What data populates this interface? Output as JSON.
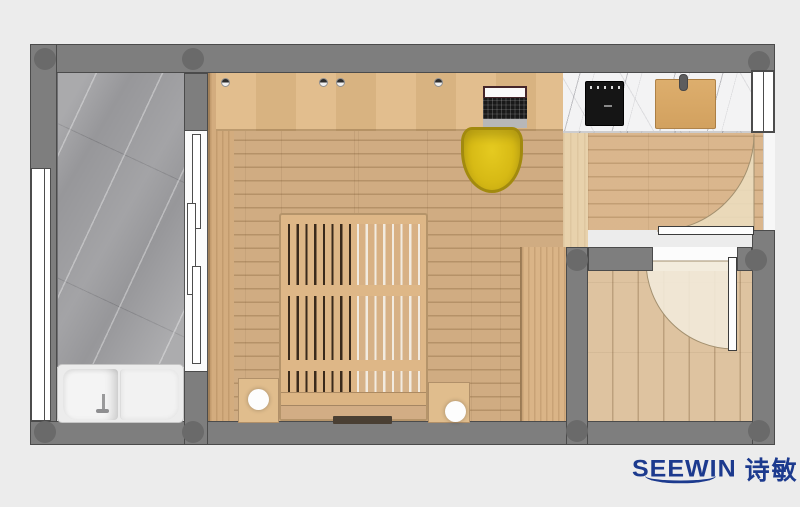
{
  "brand": {
    "name_en": "SEEWIN",
    "name_zh": "诗敏",
    "color": "#1c3a8e"
  },
  "plan": {
    "type": "apartment-floor-plan-top-view",
    "rooms": [
      {
        "name": "bathroom",
        "floor": "gray-marble",
        "fixtures": [
          "bathtub",
          "faucet",
          "sliding-door",
          "window"
        ]
      },
      {
        "name": "main-room",
        "floor": "oak-plank",
        "fixtures": [
          "desk-counter",
          "wall-knobs",
          "laptop",
          "yellow-chair",
          "slatted-platform-bed",
          "nightstand-left",
          "table-lamp-left",
          "nightstand-right",
          "table-lamp-right",
          "side-cabinet",
          "wardrobe"
        ]
      },
      {
        "name": "kitchenette-counter",
        "floor": "white-marble",
        "fixtures": [
          "cooktop",
          "cutting-board"
        ]
      },
      {
        "name": "entry",
        "floor": "oak-plank",
        "fixtures": [
          "entry-door",
          "door-swing-arc",
          "door-frame"
        ]
      },
      {
        "name": "second-room",
        "floor": "oak-plank",
        "fixtures": [
          "door",
          "door-swing-arc"
        ]
      }
    ],
    "colors": {
      "background": "#ececec",
      "wall": "#7e7e7e",
      "floor_main": "#cda87b",
      "floor_entry": "#d8b286",
      "marble_gray": "#97979a",
      "marble_white": "#f3f3f4",
      "chair_yellow": "#d7ba15",
      "bed_wood": "#deb787"
    }
  }
}
